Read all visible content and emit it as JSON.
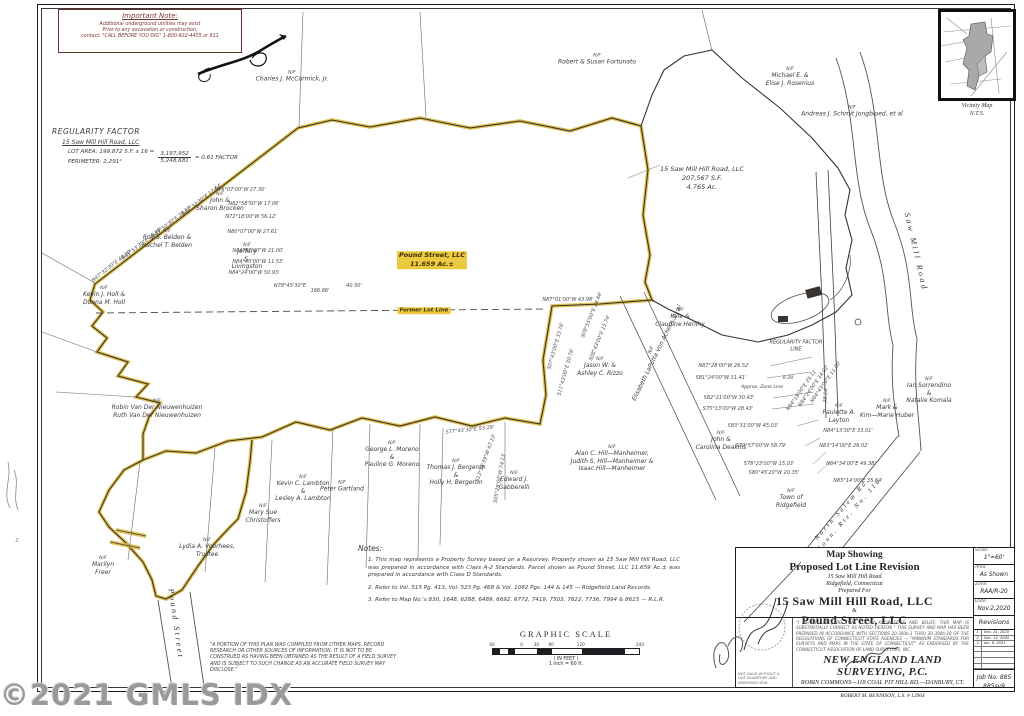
{
  "watermark": {
    "text": "©2021 GMLS IDX"
  },
  "important_note": {
    "title": "Important Note:",
    "lines": [
      "Additional underground utilities may exist",
      "Prior to any excavation or construction,",
      "contact: \"CALL BEFORE YOU DIG\" 1-800-922-4455 or 811"
    ]
  },
  "regularity_factor": {
    "title": "REGULARITY FACTOR",
    "owner": "15 Saw Mill Hill Road, LLC",
    "row1_left": "LOT AREA: 199,872 S.F. x 16 =",
    "row2_left": "PERIMETER: 2,291²",
    "numerator": "3,197,952",
    "denominator": "5,248,681",
    "result": "= 0.61 FACTOR"
  },
  "map": {
    "names": [
      {
        "nf": true,
        "lines": [
          "Charles J. McCormick, Jr."
        ],
        "x": 292,
        "y": 77
      },
      {
        "nf": true,
        "lines": [
          "Robert & Susan Fortunato"
        ],
        "x": 597,
        "y": 60
      },
      {
        "nf": true,
        "lines": [
          "Michael E. &",
          "Elise J. Rosenius"
        ],
        "x": 790,
        "y": 77
      },
      {
        "nf": true,
        "lines": [
          "Andreas J. Schmit Jongbloed, et al"
        ],
        "x": 852,
        "y": 112
      },
      {
        "nf": true,
        "lines": [
          "John &",
          "Sharon Brocken"
        ],
        "x": 220,
        "y": 202
      },
      {
        "nf": true,
        "lines": [
          "Jeffery",
          "S.",
          "Livingston"
        ],
        "x": 247,
        "y": 257
      },
      {
        "nf": true,
        "lines": [
          "Roy S. Belden &",
          "Rachel T. Belden"
        ],
        "x": 167,
        "y": 239
      },
      {
        "nf": true,
        "lines": [
          "Kevin J. Holl &",
          "Donna M. Holl"
        ],
        "x": 104,
        "y": 296
      },
      {
        "nf": true,
        "lines": [
          "Robin Van Der Nieuwenhuizen",
          "Ruth Van Der Nieuwenhuizen"
        ],
        "x": 157,
        "y": 409
      },
      {
        "nf": true,
        "lines": [
          "Kyle &",
          "Claudine Herlihy"
        ],
        "x": 680,
        "y": 318
      },
      {
        "nf": true,
        "lines": [
          "Jason W. &",
          "Ashley C. Rizzo"
        ],
        "x": 600,
        "y": 367
      },
      {
        "nf": true,
        "lines": [
          "Elisabeth LaPutta Von Achern, et al"
        ],
        "x": 655,
        "y": 352,
        "r": -64
      },
      {
        "nf": true,
        "lines": [
          "George L. Moreno",
          "&",
          "Pauline G. Moreno"
        ],
        "x": 392,
        "y": 455
      },
      {
        "nf": true,
        "lines": [
          "Peter Gartland"
        ],
        "x": 342,
        "y": 487
      },
      {
        "nf": true,
        "lines": [
          "Thomas J. Bergeron",
          "&",
          "Holly H. Bergeron"
        ],
        "x": 456,
        "y": 473
      },
      {
        "nf": true,
        "lines": [
          "Alan C. Hill—Manheimer,",
          "Judith S. Hill—Manheimer &",
          "Isaac Hill—Manheimer"
        ],
        "x": 612,
        "y": 459
      },
      {
        "nf": true,
        "lines": [
          "Edward J.",
          "Gabberelli"
        ],
        "x": 514,
        "y": 481
      },
      {
        "nf": true,
        "lines": [
          "Kevin C. Lambton",
          "&",
          "Lesley A. Lambton"
        ],
        "x": 303,
        "y": 489
      },
      {
        "nf": true,
        "lines": [
          "Mary Sue",
          "Christoffers"
        ],
        "x": 263,
        "y": 514
      },
      {
        "nf": true,
        "lines": [
          "Lydia A. Voorhees,",
          "Trustee"
        ],
        "x": 207,
        "y": 548
      },
      {
        "nf": true,
        "lines": [
          "Marilyn",
          "Freer"
        ],
        "x": 103,
        "y": 566
      },
      {
        "nf": true,
        "lines": [
          "John &",
          "Carolina Deakins"
        ],
        "x": 721,
        "y": 441
      },
      {
        "nf": true,
        "lines": [
          "Paulette A.",
          "Layton"
        ],
        "x": 839,
        "y": 414
      },
      {
        "nf": true,
        "lines": [
          "Mark &",
          "Kim—Marie Huber"
        ],
        "x": 887,
        "y": 409
      },
      {
        "nf": true,
        "lines": [
          "Ian Sorrendino",
          "&",
          "Natalie Komala"
        ],
        "x": 929,
        "y": 391
      },
      {
        "nf": true,
        "lines": [
          "Town of",
          "Ridgefield"
        ],
        "x": 791,
        "y": 499
      }
    ],
    "areas": [
      {
        "lines": [
          "15 Saw Mill Hill Road, LLC",
          "207,567 S.F.",
          "4.765 Ac."
        ],
        "x": 702,
        "y": 178,
        "size": 6.5
      },
      {
        "lines": [
          "Pound Street, LLC",
          "11.659 Ac.±"
        ],
        "x": 432,
        "y": 260,
        "hl": true,
        "size": 6.5
      },
      {
        "lines": [
          "Former Lot Line"
        ],
        "x": 424,
        "y": 311,
        "hl": true,
        "size": 5.5
      },
      {
        "lines": [
          "REGULARITY FACTOR",
          "LINE"
        ],
        "x": 796,
        "y": 346,
        "size": 5
      },
      {
        "lines": [
          "Approx. Zone Line"
        ],
        "x": 762,
        "y": 388,
        "size": 4.6
      },
      {
        "lines": [
          "R-20"
        ],
        "x": 788,
        "y": 379,
        "size": 4.6
      }
    ],
    "streets": [
      {
        "lines": [
          "Saw  Mill  Road"
        ],
        "x": 916,
        "y": 252,
        "r": 77,
        "size": 8
      },
      {
        "lines": [
          "North Salem Rd.",
          "Conn. Rte. No. 116"
        ],
        "x": 846,
        "y": 512,
        "r": -49,
        "size": 6.5
      },
      {
        "lines": [
          "Pound  Street"
        ],
        "x": 176,
        "y": 624,
        "r": 82,
        "size": 8
      }
    ],
    "bearings": [
      {
        "t": "N47°32'30\"E 48.00'",
        "x": 112,
        "y": 266,
        "r": -38
      },
      {
        "t": "N41°53'30\"E 16.96'",
        "x": 142,
        "y": 244,
        "r": -38
      },
      {
        "t": "N43°50'30\"E 28.52'",
        "x": 172,
        "y": 222,
        "r": -38
      },
      {
        "t": "N47°32'30\"E 17.64'",
        "x": 202,
        "y": 200,
        "r": -38
      },
      {
        "t": "N76°07'00\"W 27.30'",
        "x": 240,
        "y": 190,
        "r": 0
      },
      {
        "t": "N82°58'50\"W 17.06'",
        "x": 254,
        "y": 204,
        "r": 0
      },
      {
        "t": "N72°18'00\"W 56.12'",
        "x": 251,
        "y": 217,
        "r": 0
      },
      {
        "t": "N80°07'00\"W 27.61'",
        "x": 253,
        "y": 232,
        "r": 0
      },
      {
        "t": "N84°47'00\"W 21.00'",
        "x": 258,
        "y": 251,
        "r": 0
      },
      {
        "t": "N84°43'00\"W 11.53'",
        "x": 258,
        "y": 262,
        "r": 0
      },
      {
        "t": "N84°24'00\"W 50.93'",
        "x": 254,
        "y": 273,
        "r": 0
      },
      {
        "t": "N78°45'30\"E",
        "x": 290,
        "y": 286,
        "r": 0
      },
      {
        "t": "166.86'",
        "x": 320,
        "y": 291,
        "r": 0
      },
      {
        "t": "40.50'",
        "x": 354,
        "y": 286,
        "r": 0
      },
      {
        "t": "N87°01'00\"W 43.98'",
        "x": 568,
        "y": 300,
        "r": 0
      },
      {
        "t": "S09°55'00\"E 24.44'",
        "x": 592,
        "y": 315,
        "r": -68
      },
      {
        "t": "S08°43'00\"E 15.74'",
        "x": 600,
        "y": 338,
        "r": -68
      },
      {
        "t": "S07°43'00\"E 33.76'",
        "x": 556,
        "y": 346,
        "r": -74
      },
      {
        "t": "S11°43'00\"E 30.76'",
        "x": 566,
        "y": 372,
        "r": -74
      },
      {
        "t": "S77°43'30\"E 53.29'",
        "x": 470,
        "y": 430,
        "r": -6
      },
      {
        "t": "S13°38'39\"W 47.10'",
        "x": 486,
        "y": 458,
        "r": -70
      },
      {
        "t": "S05°28'00\"W 74.13'",
        "x": 500,
        "y": 478,
        "r": -80
      },
      {
        "t": "N87°28'00\"W 26.52'",
        "x": 724,
        "y": 366,
        "r": 0
      },
      {
        "t": "S81°24'00\"W 31.41'",
        "x": 721,
        "y": 378,
        "r": 0
      },
      {
        "t": "S82°21'00\"W 30.43'",
        "x": 729,
        "y": 398,
        "r": 0
      },
      {
        "t": "S75°13'00\"W 28.43'",
        "x": 728,
        "y": 409,
        "r": 0
      },
      {
        "t": "S83°31'00\"W 45.03'",
        "x": 753,
        "y": 426,
        "r": 0
      },
      {
        "t": "S79°57'00\"W 58.79'",
        "x": 761,
        "y": 446,
        "r": 0
      },
      {
        "t": "S78°23'00\"W 15.03'",
        "x": 769,
        "y": 464,
        "r": 0
      },
      {
        "t": "S80°45'20\"W 20.35'",
        "x": 774,
        "y": 473,
        "r": 0
      },
      {
        "t": "N84°13'30\"E 33.01'",
        "x": 848,
        "y": 431,
        "r": 0
      },
      {
        "t": "N83°14'00\"E 26.02'",
        "x": 844,
        "y": 446,
        "r": 0
      },
      {
        "t": "N84°34'00\"E 49.38'",
        "x": 851,
        "y": 464,
        "r": 0
      },
      {
        "t": "N85°14'00\"E 35.64'",
        "x": 858,
        "y": 481,
        "r": 0
      },
      {
        "t": "N84°18'00\"E 29.11'",
        "x": 802,
        "y": 390,
        "r": -55
      },
      {
        "t": "N84°24'00\"E 14.02'",
        "x": 814,
        "y": 386,
        "r": -55
      },
      {
        "t": "N84°43'00\"E 11.00'",
        "x": 826,
        "y": 382,
        "r": -55
      },
      {
        "t": "25.14'",
        "x": 826,
        "y": 395,
        "r": -85
      }
    ],
    "margin_marks": [
      {
        "t": "2",
        "x": 17,
        "y": 541,
        "r": 0
      }
    ]
  },
  "notes": {
    "title": "Notes:",
    "items": [
      "This map represents a Property Survey based on a Resurvey. Property shown as 15 Saw Mill Hill Road, LLC was prepared in accordance with Class A-2 Standards. Parcel shown as Pound Street, LLC 11.659 Ac.± was prepared in accordance with Class D Standards.",
      "Refer to Vol. 515 Pg. 413, Vol. 523 Pg. 468 & Vol. 1082 Pgs. 144 & 145 — Ridgefield Land Records.",
      "Refer to Map No.'s 830, 1648, 6288, 6489, 6692, 6772, 7419, 7503, 7622, 7736, 7994 & 8615 — R.L.R."
    ]
  },
  "compiled_note": "\"A PORTION OF THIS PLAN WAS COMPILED FROM OTHER MAPS, RECORD RESEARCH OR OTHER SOURCES OF INFORMATION. IT IS NOT TO BE CONSTRUED AS HAVING BEEN OBTAINED AS THE RESULT OF A FIELD SURVEY AND IS SUBJECT TO SUCH CHANGE AS AN ACCURATE FIELD SURVEY MAY DISCLOSE.\"",
  "graphic_scale": {
    "title": "GRAPHIC SCALE",
    "ticks": [
      {
        "t": "60",
        "f": 0
      },
      {
        "t": "0",
        "f": 0.2
      },
      {
        "t": "30",
        "f": 0.3
      },
      {
        "t": "60",
        "f": 0.4
      },
      {
        "t": "120",
        "f": 0.6
      },
      {
        "t": "240",
        "f": 1
      }
    ],
    "feet_label": "( IN FEET )",
    "inch_label": "1 inch = 60  ft."
  },
  "vicinity": {
    "caption_line1": "Vicinity Map",
    "caption_line2": "N.T.S."
  },
  "title_block": {
    "title_line1": "Map Showing",
    "title_line2": "Proposed Lot Line Revision",
    "addr1": "15 Saw Mill Hill Road",
    "addr2": "Ridgefield, Connecticut",
    "prepared": "Prepared For",
    "client1": "15 Saw Mill Hill Road, LLC",
    "amp": "&",
    "client2": "Pound Street, LLC",
    "cert": "\"I HEREBY DECLARE THAT TO MY KNOWLEDGE AND BELIEF, THIS MAP IS SUBSTANTIALLY CORRECT AS NOTED HEREON.\" THIS SURVEY AND MAP HAS BEEN PREPARED IN ACCORDANCE WITH SECTIONS 20-300b-1 THRU 20-300b-20 OF THE REGULATIONS OF CONNECTICUT STATE AGENCIES — \"MINIMUM STANDARDS FOR SURVEYS AND MAPS IN THE STATE OF CONNECTICUT\" AS ENDORSED BY THE CONNECTICUT ASSOCIATION OF LAND SURVEYORS, INC.",
    "firm": "NEW ENGLAND LAND SURVEYING, P.C.",
    "firm_addr": "ROBIN COMMONS—118 COAL PIT HILL RD.—DANBURY, CT.",
    "surveyor": "ROBERT M. BENNISON, L.S. # 12964",
    "stamp": "NOT VALID WITHOUT A LIVE SIGNATURE AND EMBOSSED SEAL",
    "meta": [
      {
        "label": "Scale:",
        "value": "1\"=60'"
      },
      {
        "label": "Area:",
        "value": "As Shown"
      },
      {
        "label": "Zone:",
        "value": "RAA/R-20"
      },
      {
        "label": "Date:",
        "value": "Nov.2,2020"
      }
    ],
    "revisions_title": "Revisions",
    "revisions": [
      {
        "no": "1",
        "date": "Nov. 24, 2020"
      },
      {
        "no": "2",
        "date": "Dec. 14, 2020"
      },
      {
        "no": "3",
        "date": "Jan. 8, 2021"
      }
    ],
    "job_line1": "Job No. 885",
    "job_line2": "885sv9"
  }
}
